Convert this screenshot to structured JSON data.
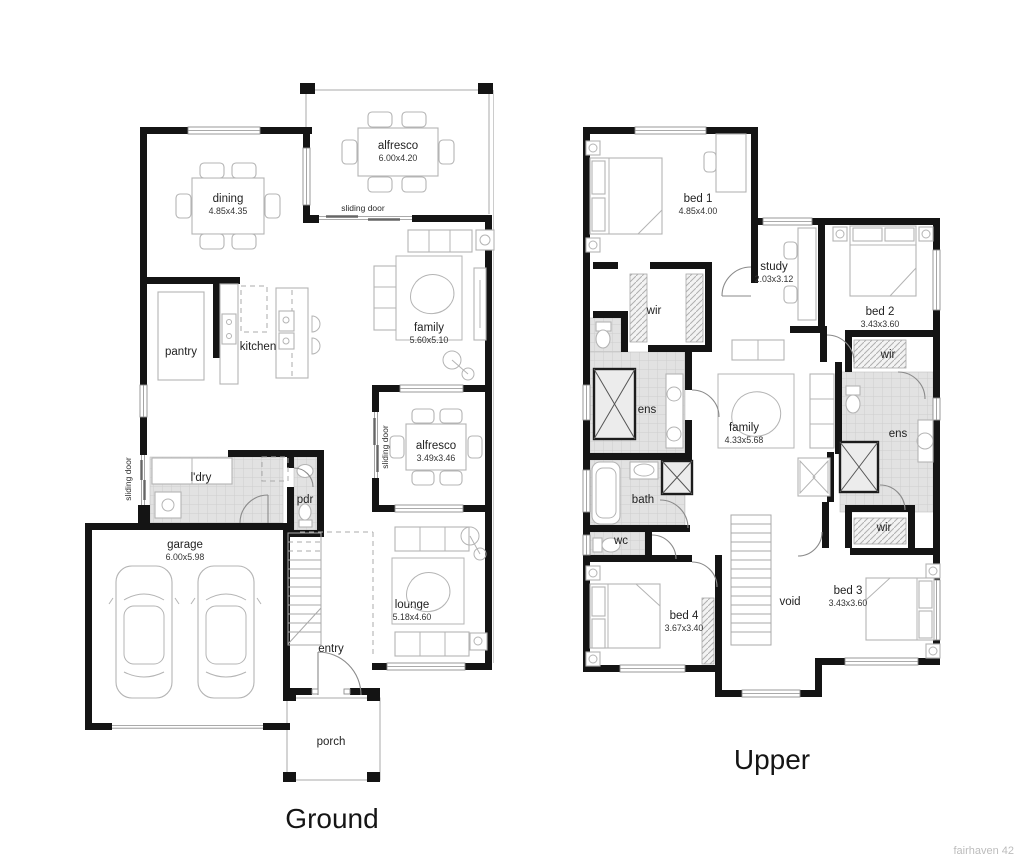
{
  "meta": {
    "watermark": "fairhaven 42"
  },
  "colors": {
    "background": "#ffffff",
    "wall": "#141414",
    "furniture_line": "#b4b4b4",
    "tile_fill": "#e2e2e2",
    "tile_grid": "#cecece",
    "label_text": "#222222",
    "watermark_text": "#bcbcbc"
  },
  "ground": {
    "title": "Ground",
    "labels": {
      "alfresco_rear": {
        "name": "alfresco",
        "dims": "6.00x4.20"
      },
      "dining": {
        "name": "dining",
        "dims": "4.85x4.35"
      },
      "family": {
        "name": "family",
        "dims": "5.60x5.10"
      },
      "pantry": {
        "name": "pantry"
      },
      "kitchen": {
        "name": "kitchen"
      },
      "ldry": {
        "name": "l'dry"
      },
      "pdr": {
        "name": "pdr"
      },
      "alfresco_side": {
        "name": "alfresco",
        "dims": "3.49x3.46"
      },
      "garage": {
        "name": "garage",
        "dims": "6.00x5.98"
      },
      "lounge": {
        "name": "lounge",
        "dims": "5.18x4.60"
      },
      "entry": {
        "name": "entry"
      },
      "porch": {
        "name": "porch"
      },
      "sliding_door_rear": "sliding door",
      "sliding_door_left": "sliding door",
      "sliding_door_alfresco": "sliding door"
    }
  },
  "upper": {
    "title": "Upper",
    "labels": {
      "bed1": {
        "name": "bed 1",
        "dims": "4.85x4.00"
      },
      "study": {
        "name": "study",
        "dims": "2.03x3.12"
      },
      "bed2": {
        "name": "bed 2",
        "dims": "3.43x3.60"
      },
      "wir_bed1": {
        "name": "wir"
      },
      "wir_bed2": {
        "name": "wir"
      },
      "wir_bed3": {
        "name": "wir"
      },
      "ens_main": {
        "name": "ens"
      },
      "ens_bed2": {
        "name": "ens"
      },
      "family": {
        "name": "family",
        "dims": "4.33x5.68"
      },
      "bath": {
        "name": "bath"
      },
      "wc": {
        "name": "wc"
      },
      "bed4": {
        "name": "bed 4",
        "dims": "3.67x3.40"
      },
      "void": {
        "name": "void"
      },
      "bed3": {
        "name": "bed 3",
        "dims": "3.43x3.60"
      }
    }
  }
}
